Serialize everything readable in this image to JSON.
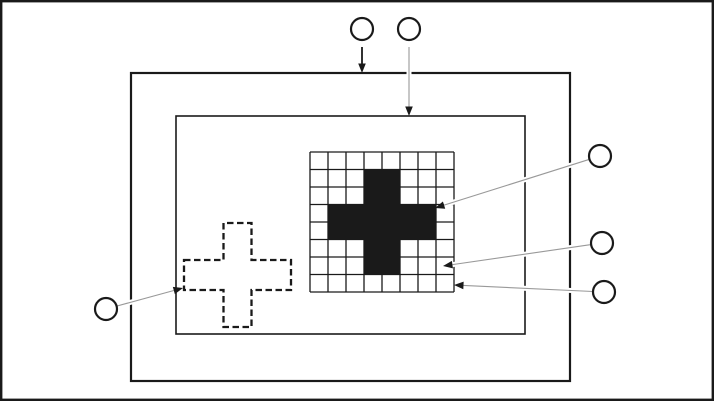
{
  "figure": {
    "description": "nested-rectangle diagram with pixel-grid filled cross, dashed cross outline and empty callout circles",
    "canvas": {
      "width": 714,
      "height": 401,
      "background": "#ffffff"
    },
    "colors": {
      "ink": "#1a1a1a",
      "leader": "#999999",
      "white": "#ffffff"
    },
    "frame": {
      "x": 1.2,
      "y": 1.2,
      "width": 711.6,
      "height": 398.6,
      "stroke_width": 2.4
    },
    "outer_rect": {
      "x": 131,
      "y": 73,
      "width": 439,
      "height": 308,
      "stroke_width": 2.2
    },
    "inner_rect": {
      "x": 176,
      "y": 116,
      "width": 349,
      "height": 218,
      "stroke_width": 1.6
    },
    "grid": {
      "x": 310,
      "y": 152,
      "cols": 8,
      "rows": 8,
      "cell_width": 18,
      "cell_height": 17.5,
      "stroke_width": 1.3
    },
    "filled_cross": {
      "vertical_bar": {
        "col_start": 3,
        "col_span": 2,
        "row_start": 1,
        "row_span": 6
      },
      "horizontal_bar": {
        "col_start": 1,
        "col_span": 6,
        "row_start": 3,
        "row_span": 2
      }
    },
    "dashed_cross": {
      "horiz": {
        "x1": 184,
        "x2": 291,
        "y1": 260,
        "y2": 290
      },
      "vert": {
        "x1": 223.5,
        "x2": 251.5,
        "y1": 223,
        "y2": 327
      },
      "stroke_width": 2.3,
      "dash": "6.5 3.5"
    },
    "arrowhead": {
      "length": 9.5,
      "half_width": 3.8
    },
    "circle_style": {
      "r": 11,
      "stroke_width": 2.2,
      "fill": "#ffffff"
    },
    "callouts": [
      {
        "id": "top-left",
        "label": "",
        "circle": {
          "cx": 362,
          "cy": 29
        },
        "arrow": {
          "from": [
            362,
            47
          ],
          "tip": [
            362,
            73
          ],
          "color": "ink",
          "width": 1.8,
          "casing": false
        }
      },
      {
        "id": "top-right",
        "label": "",
        "circle": {
          "cx": 409,
          "cy": 29
        },
        "arrow": {
          "from": [
            409,
            47
          ],
          "tip": [
            409,
            116
          ],
          "color": "leader",
          "width": 1.1,
          "casing": true
        }
      },
      {
        "id": "right-upper",
        "label": "",
        "circle": {
          "cx": 600,
          "cy": 156
        },
        "arrow": {
          "from": [
            589.5,
            159.3
          ],
          "tip": [
            435,
            208
          ],
          "color": "leader",
          "width": 1.1,
          "casing": true
        }
      },
      {
        "id": "right-middle",
        "label": "",
        "circle": {
          "cx": 602,
          "cy": 243
        },
        "arrow": {
          "from": [
            591.1,
            244.6
          ],
          "tip": [
            443,
            266
          ],
          "color": "leader",
          "width": 1.1,
          "casing": true
        }
      },
      {
        "id": "right-lower",
        "label": "",
        "circle": {
          "cx": 604,
          "cy": 292
        },
        "arrow": {
          "from": [
            593.1,
            291.5
          ],
          "tip": [
            454,
            285
          ],
          "color": "leader",
          "width": 1.1,
          "casing": true
        }
      },
      {
        "id": "left",
        "label": "",
        "circle": {
          "cx": 106,
          "cy": 309
        },
        "arrow": {
          "from": [
            116.6,
            306.1
          ],
          "tip": [
            183,
            288
          ],
          "color": "leader",
          "width": 1.1,
          "casing": true
        }
      }
    ]
  }
}
